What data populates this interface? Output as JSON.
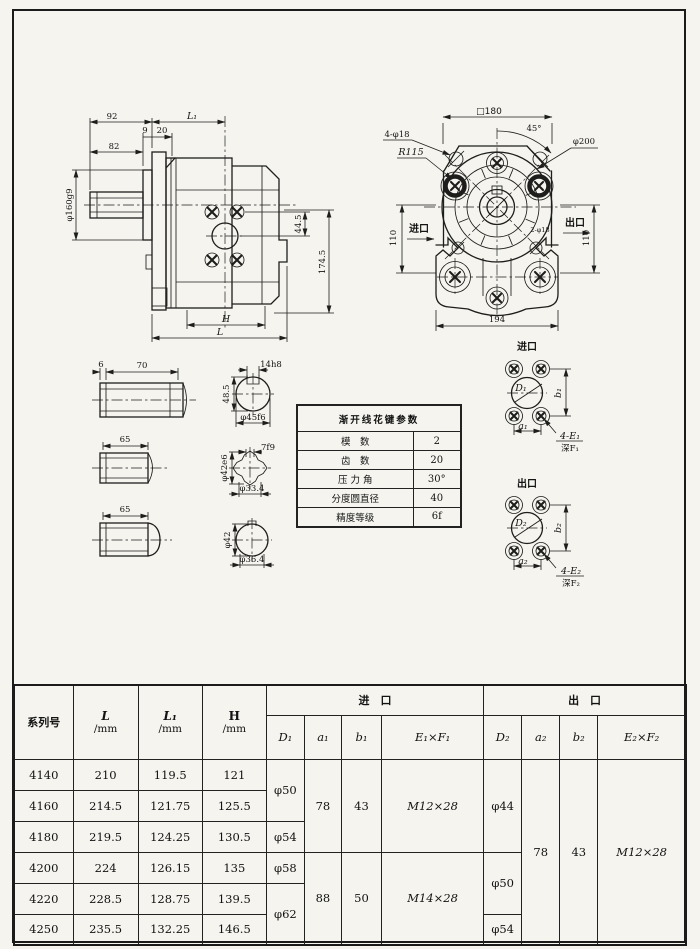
{
  "side_view": {
    "dim_92": "92",
    "dim_9": "9",
    "dim_20": "20",
    "dim_L1": "L₁",
    "dim_82": "82",
    "dim_phi160": "φ160g9",
    "dim_44_5": "44.5",
    "dim_174_5": "174.5",
    "dim_H": "H",
    "dim_L": "L"
  },
  "front_view": {
    "dim_square180": "□180",
    "dim_45": "45°",
    "dim_phi200": "φ200",
    "dim_4phi18": "4-φ18",
    "dim_R115": "R115",
    "label_inlet": "进口",
    "label_outlet": "出口",
    "dim_110_left": "110",
    "dim_110_right": "110",
    "dim_2phi18": "2-φ18",
    "dim_194": "194"
  },
  "shafts": {
    "key_shaft": {
      "dim_6": "6",
      "dim_70": "70",
      "dim_14h8": "14h8",
      "dim_48_5": "48.5",
      "dim_phi45f6": "φ45f6"
    },
    "spline_shaft": {
      "dim_65": "65",
      "dim_7f9": "7f9",
      "dim_phi42e6": "φ42e6",
      "dim_phi33_4": "φ33.4"
    },
    "plain_shaft": {
      "dim_65": "65",
      "dim_phi42": "φ42",
      "dim_phi36_4": "φ36.4"
    }
  },
  "spline_table": {
    "title": "渐开线花键参数",
    "rows": [
      {
        "label": "模　数",
        "value": "2"
      },
      {
        "label": "齿　数",
        "value": "20"
      },
      {
        "label": "压 力 角",
        "value": "30°"
      },
      {
        "label": "分度圆直径",
        "value": "40"
      },
      {
        "label": "精度等级",
        "value": "6f"
      }
    ]
  },
  "inlet_detail": {
    "title": "进口",
    "D": "D₁",
    "a": "a₁",
    "b": "b₁",
    "holes": "4-E₁",
    "depth": "深F₁"
  },
  "outlet_detail": {
    "title": "出口",
    "D": "D₂",
    "a": "a₂",
    "b": "b₂",
    "holes": "4-E₂",
    "depth": "深F₂"
  },
  "data_table": {
    "header": {
      "series": "系列号",
      "L": "L",
      "L1": "L₁",
      "H": "H",
      "unit": "/mm",
      "inlet": "进　口",
      "outlet": "出　口",
      "D1": "D₁",
      "a1": "a₁",
      "b1": "b₁",
      "E1F1": "E₁×F₁",
      "D2": "D₂",
      "a2": "a₂",
      "b2": "b₂",
      "E2F2": "E₂×F₂"
    },
    "rows": {
      "r4140": {
        "series": "4140",
        "L": "210",
        "L1": "119.5",
        "H": "121",
        "D1": "φ50",
        "a1": "78",
        "b1": "43",
        "E1F1": "M12×28",
        "D2": "φ44",
        "a2": "78",
        "b2": "43",
        "E2F2": "M12×28"
      },
      "r4160": {
        "series": "4160",
        "L": "214.5",
        "L1": "121.75",
        "H": "125.5"
      },
      "r4180": {
        "series": "4180",
        "L": "219.5",
        "L1": "124.25",
        "H": "130.5",
        "D1": "φ54"
      },
      "r4200": {
        "series": "4200",
        "L": "224",
        "L1": "126.15",
        "H": "135",
        "D1": "φ58",
        "a1": "88",
        "b1": "50",
        "E1F1": "M14×28",
        "D2": "φ50"
      },
      "r4220": {
        "series": "4220",
        "L": "228.5",
        "L1": "128.75",
        "H": "139.5",
        "D1": "φ62"
      },
      "r4250": {
        "series": "4250",
        "L": "235.5",
        "L1": "132.25",
        "H": "146.5",
        "D2": "φ54"
      }
    }
  }
}
